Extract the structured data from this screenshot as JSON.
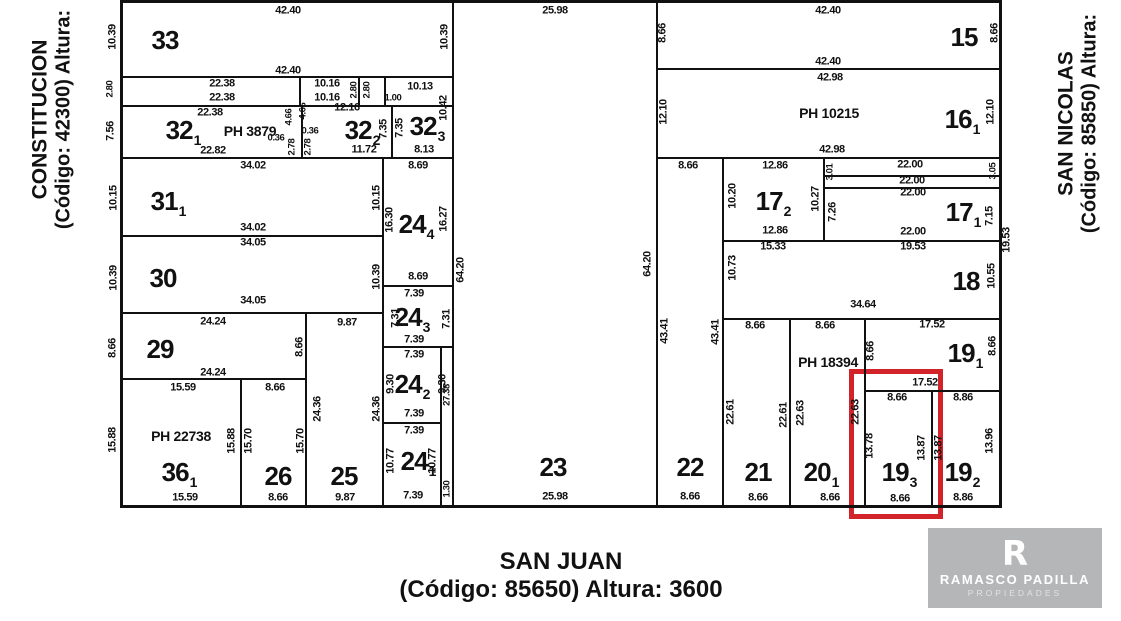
{
  "streets": {
    "left": {
      "name": "CONSTITUCION",
      "detail": "(Código: 42300) Altura:"
    },
    "right": {
      "name": "SAN NICOLAS",
      "detail": "(Código: 85850) Altura:"
    },
    "bottom": {
      "name": "SAN JUAN",
      "detail": "(Código: 85650) Altura: 3600"
    }
  },
  "logo": {
    "mark": "R",
    "brand": "RAMASCO PADILLA",
    "tagline": "PROPIEDADES"
  },
  "colors": {
    "line": "#111111",
    "highlight_red": "#d2232a",
    "logo_bg": "#b5b6b8",
    "background": "#ffffff"
  },
  "plan": {
    "highlight": {
      "x": 849,
      "y": 369,
      "w": 94,
      "h": 150
    },
    "lines": [
      {
        "x": 120,
        "y": 0,
        "w": 882,
        "h": 3
      },
      {
        "x": 120,
        "y": 505,
        "w": 882,
        "h": 3
      },
      {
        "x": 120,
        "y": 0,
        "w": 3,
        "h": 508
      },
      {
        "x": 999,
        "y": 0,
        "w": 3,
        "h": 508
      },
      {
        "x": 452,
        "y": 0,
        "w": 2,
        "h": 507
      },
      {
        "x": 440,
        "y": 346,
        "w": 2,
        "h": 161
      },
      {
        "x": 656,
        "y": 0,
        "w": 2,
        "h": 507
      },
      {
        "x": 722,
        "y": 157,
        "w": 2,
        "h": 350
      },
      {
        "x": 789,
        "y": 318,
        "w": 2,
        "h": 189
      },
      {
        "x": 864,
        "y": 318,
        "w": 2,
        "h": 189
      },
      {
        "x": 931,
        "y": 390,
        "w": 2,
        "h": 117
      },
      {
        "x": 299,
        "y": 76,
        "w": 2,
        "h": 30
      },
      {
        "x": 358,
        "y": 76,
        "w": 2,
        "h": 30
      },
      {
        "x": 384,
        "y": 76,
        "w": 2,
        "h": 30
      },
      {
        "x": 301,
        "y": 105,
        "w": 2,
        "h": 53
      },
      {
        "x": 391,
        "y": 105,
        "w": 2,
        "h": 53
      },
      {
        "x": 382,
        "y": 157,
        "w": 2,
        "h": 350
      },
      {
        "x": 823,
        "y": 157,
        "w": 2,
        "h": 84
      },
      {
        "x": 305,
        "y": 312,
        "w": 2,
        "h": 195
      },
      {
        "x": 240,
        "y": 378,
        "w": 2,
        "h": 129
      },
      {
        "x": 122,
        "y": 76,
        "w": 331,
        "h": 2
      },
      {
        "x": 122,
        "y": 105,
        "w": 331,
        "h": 2
      },
      {
        "x": 122,
        "y": 157,
        "w": 331,
        "h": 2
      },
      {
        "x": 656,
        "y": 68,
        "w": 345,
        "h": 2
      },
      {
        "x": 656,
        "y": 157,
        "w": 345,
        "h": 2
      },
      {
        "x": 122,
        "y": 235,
        "w": 261,
        "h": 2
      },
      {
        "x": 122,
        "y": 312,
        "w": 261,
        "h": 2
      },
      {
        "x": 122,
        "y": 378,
        "w": 185,
        "h": 2
      },
      {
        "x": 823,
        "y": 175,
        "w": 178,
        "h": 2
      },
      {
        "x": 823,
        "y": 187,
        "w": 178,
        "h": 2
      },
      {
        "x": 722,
        "y": 240,
        "w": 279,
        "h": 2
      },
      {
        "x": 722,
        "y": 318,
        "w": 279,
        "h": 2
      },
      {
        "x": 864,
        "y": 390,
        "w": 137,
        "h": 2
      },
      {
        "x": 382,
        "y": 285,
        "w": 71,
        "h": 2
      },
      {
        "x": 382,
        "y": 346,
        "w": 71,
        "h": 2
      },
      {
        "x": 382,
        "y": 422,
        "w": 59,
        "h": 2
      }
    ],
    "parcels": [
      {
        "n": "33",
        "x": 165,
        "y": 40
      },
      {
        "n": "32",
        "sub": "1",
        "x": 183,
        "y": 130
      },
      {
        "n": "32",
        "sub": "2",
        "x": 362,
        "y": 130
      },
      {
        "n": "32",
        "sub": "3",
        "x": 427,
        "y": 126
      },
      {
        "n": "31",
        "sub": "1",
        "x": 168,
        "y": 201
      },
      {
        "n": "30",
        "x": 163,
        "y": 278
      },
      {
        "n": "29",
        "x": 160,
        "y": 349
      },
      {
        "n": "36",
        "sub": "1",
        "x": 179,
        "y": 472
      },
      {
        "n": "26",
        "x": 278,
        "y": 476
      },
      {
        "n": "25",
        "x": 344,
        "y": 476
      },
      {
        "n": "24",
        "sub": "4",
        "x": 416,
        "y": 224
      },
      {
        "n": "24",
        "sub": "3",
        "x": 412,
        "y": 317
      },
      {
        "n": "24",
        "sub": "2",
        "x": 412,
        "y": 384
      },
      {
        "n": "24",
        "sub": "1",
        "x": 418,
        "y": 461
      },
      {
        "n": "23",
        "x": 553,
        "y": 467
      },
      {
        "n": "22",
        "x": 690,
        "y": 467
      },
      {
        "n": "21",
        "x": 758,
        "y": 472
      },
      {
        "n": "20",
        "sub": "1",
        "x": 821,
        "y": 472
      },
      {
        "n": "19",
        "sub": "3",
        "x": 899,
        "y": 472
      },
      {
        "n": "19",
        "sub": "2",
        "x": 962,
        "y": 472
      },
      {
        "n": "19",
        "sub": "1",
        "x": 965,
        "y": 353
      },
      {
        "n": "18",
        "x": 966,
        "y": 281
      },
      {
        "n": "17",
        "sub": "2",
        "x": 773,
        "y": 201
      },
      {
        "n": "17",
        "sub": "1",
        "x": 963,
        "y": 212
      },
      {
        "n": "16",
        "sub": "1",
        "x": 962,
        "y": 119
      },
      {
        "n": "15",
        "x": 964,
        "y": 37
      }
    ],
    "ph_labels": [
      {
        "t": "PH 3879",
        "x": 250,
        "y": 131
      },
      {
        "t": "PH 22738",
        "x": 181,
        "y": 436
      },
      {
        "t": "PH 10215",
        "x": 829,
        "y": 113
      },
      {
        "t": "PH 18394",
        "x": 828,
        "y": 362
      }
    ],
    "dims": [
      {
        "t": "42.40",
        "x": 288,
        "y": 11
      },
      {
        "t": "25.98",
        "x": 555,
        "y": 11
      },
      {
        "t": "42.40",
        "x": 828,
        "y": 11
      },
      {
        "t": "10.39",
        "x": 113,
        "y": 37,
        "v": 1
      },
      {
        "t": "10.39",
        "x": 445,
        "y": 37,
        "v": 1
      },
      {
        "t": "42.40",
        "x": 288,
        "y": 71
      },
      {
        "t": "2.80",
        "x": 110,
        "y": 89,
        "v": 1,
        "s": 1
      },
      {
        "t": "22.38",
        "x": 222,
        "y": 84
      },
      {
        "t": "22.38",
        "x": 222,
        "y": 98
      },
      {
        "t": "10.16",
        "x": 327,
        "y": 84
      },
      {
        "t": "10.16",
        "x": 327,
        "y": 98
      },
      {
        "t": "2.80",
        "x": 354,
        "y": 90,
        "v": 1,
        "s": 1
      },
      {
        "t": "2.80",
        "x": 367,
        "y": 90,
        "v": 1,
        "s": 1
      },
      {
        "t": "1.00",
        "x": 393,
        "y": 98,
        "s": 1
      },
      {
        "t": "10.13",
        "x": 420,
        "y": 87
      },
      {
        "t": "7.56",
        "x": 111,
        "y": 131,
        "v": 1
      },
      {
        "t": "22.38",
        "x": 210,
        "y": 113
      },
      {
        "t": "12.16",
        "x": 347,
        "y": 108
      },
      {
        "t": "4.66",
        "x": 289,
        "y": 117,
        "v": 1,
        "s": 1
      },
      {
        "t": "4.66",
        "x": 303,
        "y": 111,
        "v": 1,
        "s": 1
      },
      {
        "t": "0.36",
        "x": 276,
        "y": 138,
        "s": 1
      },
      {
        "t": "0.36",
        "x": 310,
        "y": 131,
        "s": 1
      },
      {
        "t": "2.78",
        "x": 292,
        "y": 147,
        "v": 1,
        "s": 1
      },
      {
        "t": "2.78",
        "x": 308,
        "y": 147,
        "v": 1,
        "s": 1
      },
      {
        "t": "22.82",
        "x": 213,
        "y": 151
      },
      {
        "t": "11.72",
        "x": 364,
        "y": 150
      },
      {
        "t": "7.35",
        "x": 384,
        "y": 129,
        "v": 1
      },
      {
        "t": "7.35",
        "x": 400,
        "y": 128,
        "v": 1
      },
      {
        "t": "10.42",
        "x": 444,
        "y": 108,
        "v": 1
      },
      {
        "t": "8.13",
        "x": 424,
        "y": 150
      },
      {
        "t": "34.02",
        "x": 253,
        "y": 166
      },
      {
        "t": "10.15",
        "x": 114,
        "y": 198,
        "v": 1
      },
      {
        "t": "10.15",
        "x": 377,
        "y": 198,
        "v": 1
      },
      {
        "t": "34.02",
        "x": 253,
        "y": 228
      },
      {
        "t": "34.05",
        "x": 253,
        "y": 243
      },
      {
        "t": "10.39",
        "x": 114,
        "y": 278,
        "v": 1
      },
      {
        "t": "10.39",
        "x": 377,
        "y": 277,
        "v": 1
      },
      {
        "t": "34.05",
        "x": 253,
        "y": 301
      },
      {
        "t": "8.69",
        "x": 418,
        "y": 166
      },
      {
        "t": "16.30",
        "x": 390,
        "y": 220,
        "v": 1
      },
      {
        "t": "16.27",
        "x": 444,
        "y": 219,
        "v": 1
      },
      {
        "t": "8.69",
        "x": 418,
        "y": 277
      },
      {
        "t": "7.39",
        "x": 414,
        "y": 294
      },
      {
        "t": "7.31",
        "x": 396,
        "y": 318,
        "v": 1
      },
      {
        "t": "7.31",
        "x": 447,
        "y": 319,
        "v": 1
      },
      {
        "t": "7.39",
        "x": 414,
        "y": 340
      },
      {
        "t": "7.39",
        "x": 414,
        "y": 355
      },
      {
        "t": "9.30",
        "x": 391,
        "y": 384,
        "v": 1
      },
      {
        "t": "9.30",
        "x": 443,
        "y": 384,
        "v": 1
      },
      {
        "t": "7.39",
        "x": 414,
        "y": 414
      },
      {
        "t": "7.39",
        "x": 414,
        "y": 431
      },
      {
        "t": "10.77",
        "x": 391,
        "y": 461,
        "v": 1
      },
      {
        "t": "10.77",
        "x": 433,
        "y": 461,
        "v": 1
      },
      {
        "t": "7.39",
        "x": 413,
        "y": 496
      },
      {
        "t": "27.38",
        "x": 447,
        "y": 395,
        "v": 1,
        "s": 1
      },
      {
        "t": "1.30",
        "x": 447,
        "y": 489,
        "v": 1,
        "s": 1
      },
      {
        "t": "8.66",
        "x": 113,
        "y": 348,
        "v": 1
      },
      {
        "t": "24.24",
        "x": 213,
        "y": 322
      },
      {
        "t": "9.87",
        "x": 347,
        "y": 323
      },
      {
        "t": "8.66",
        "x": 300,
        "y": 347,
        "v": 1
      },
      {
        "t": "24.24",
        "x": 213,
        "y": 373
      },
      {
        "t": "15.59",
        "x": 183,
        "y": 388
      },
      {
        "t": "8.66",
        "x": 275,
        "y": 388
      },
      {
        "t": "24.36",
        "x": 318,
        "y": 409,
        "v": 1
      },
      {
        "t": "24.36",
        "x": 377,
        "y": 409,
        "v": 1
      },
      {
        "t": "15.88",
        "x": 113,
        "y": 440,
        "v": 1
      },
      {
        "t": "15.88",
        "x": 232,
        "y": 441,
        "v": 1
      },
      {
        "t": "15.70",
        "x": 249,
        "y": 441,
        "v": 1
      },
      {
        "t": "15.70",
        "x": 301,
        "y": 441,
        "v": 1
      },
      {
        "t": "15.59",
        "x": 185,
        "y": 498
      },
      {
        "t": "8.66",
        "x": 278,
        "y": 498
      },
      {
        "t": "9.87",
        "x": 345,
        "y": 498
      },
      {
        "t": "64.20",
        "x": 461,
        "y": 270,
        "v": 1
      },
      {
        "t": "64.20",
        "x": 648,
        "y": 264,
        "v": 1
      },
      {
        "t": "25.98",
        "x": 555,
        "y": 497
      },
      {
        "t": "43.41",
        "x": 665,
        "y": 331,
        "v": 1
      },
      {
        "t": "43.41",
        "x": 716,
        "y": 332,
        "v": 1
      },
      {
        "t": "8.66",
        "x": 690,
        "y": 497
      },
      {
        "t": "8.66",
        "x": 663,
        "y": 33,
        "v": 1
      },
      {
        "t": "8.66",
        "x": 995,
        "y": 33,
        "v": 1
      },
      {
        "t": "42.40",
        "x": 828,
        "y": 62
      },
      {
        "t": "42.98",
        "x": 830,
        "y": 78
      },
      {
        "t": "12.10",
        "x": 664,
        "y": 112,
        "v": 1
      },
      {
        "t": "12.10",
        "x": 991,
        "y": 112,
        "v": 1
      },
      {
        "t": "42.98",
        "x": 832,
        "y": 150
      },
      {
        "t": "8.66",
        "x": 688,
        "y": 166
      },
      {
        "t": "12.86",
        "x": 775,
        "y": 166
      },
      {
        "t": "22.00",
        "x": 910,
        "y": 165
      },
      {
        "t": "3.01",
        "x": 830,
        "y": 172,
        "v": 1,
        "s": 1
      },
      {
        "t": "3.05",
        "x": 993,
        "y": 171,
        "v": 1,
        "s": 1
      },
      {
        "t": "22.00",
        "x": 912,
        "y": 181
      },
      {
        "t": "22.00",
        "x": 913,
        "y": 193
      },
      {
        "t": "10.20",
        "x": 733,
        "y": 196,
        "v": 1
      },
      {
        "t": "10.27",
        "x": 816,
        "y": 199,
        "v": 1
      },
      {
        "t": "7.26",
        "x": 833,
        "y": 212,
        "v": 1
      },
      {
        "t": "7.15",
        "x": 990,
        "y": 216,
        "v": 1
      },
      {
        "t": "12.86",
        "x": 775,
        "y": 231
      },
      {
        "t": "22.00",
        "x": 913,
        "y": 232
      },
      {
        "t": "19.53",
        "x": 1007,
        "y": 240,
        "v": 1
      },
      {
        "t": "15.33",
        "x": 773,
        "y": 247
      },
      {
        "t": "19.53",
        "x": 913,
        "y": 247
      },
      {
        "t": "10.73",
        "x": 733,
        "y": 268,
        "v": 1
      },
      {
        "t": "10.55",
        "x": 992,
        "y": 276,
        "v": 1
      },
      {
        "t": "34.64",
        "x": 863,
        "y": 305
      },
      {
        "t": "8.66",
        "x": 755,
        "y": 326
      },
      {
        "t": "8.66",
        "x": 825,
        "y": 326
      },
      {
        "t": "17.52",
        "x": 932,
        "y": 325
      },
      {
        "t": "8.66",
        "x": 871,
        "y": 351,
        "v": 1
      },
      {
        "t": "8.66",
        "x": 993,
        "y": 346,
        "v": 1
      },
      {
        "t": "17.52",
        "x": 925,
        "y": 383
      },
      {
        "t": "8.66",
        "x": 897,
        "y": 398
      },
      {
        "t": "8.86",
        "x": 963,
        "y": 398
      },
      {
        "t": "22.61",
        "x": 731,
        "y": 412,
        "v": 1
      },
      {
        "t": "22.61",
        "x": 784,
        "y": 415,
        "v": 1
      },
      {
        "t": "22.63",
        "x": 801,
        "y": 413,
        "v": 1
      },
      {
        "t": "22.63",
        "x": 856,
        "y": 412,
        "v": 1
      },
      {
        "t": "13.78",
        "x": 870,
        "y": 446,
        "v": 1
      },
      {
        "t": "13.87",
        "x": 922,
        "y": 448,
        "v": 1
      },
      {
        "t": "13.87",
        "x": 939,
        "y": 448,
        "v": 1
      },
      {
        "t": "13.96",
        "x": 990,
        "y": 441,
        "v": 1
      },
      {
        "t": "8.66",
        "x": 758,
        "y": 498
      },
      {
        "t": "8.66",
        "x": 830,
        "y": 498
      },
      {
        "t": "8.66",
        "x": 900,
        "y": 499
      },
      {
        "t": "8.86",
        "x": 963,
        "y": 498
      }
    ]
  }
}
